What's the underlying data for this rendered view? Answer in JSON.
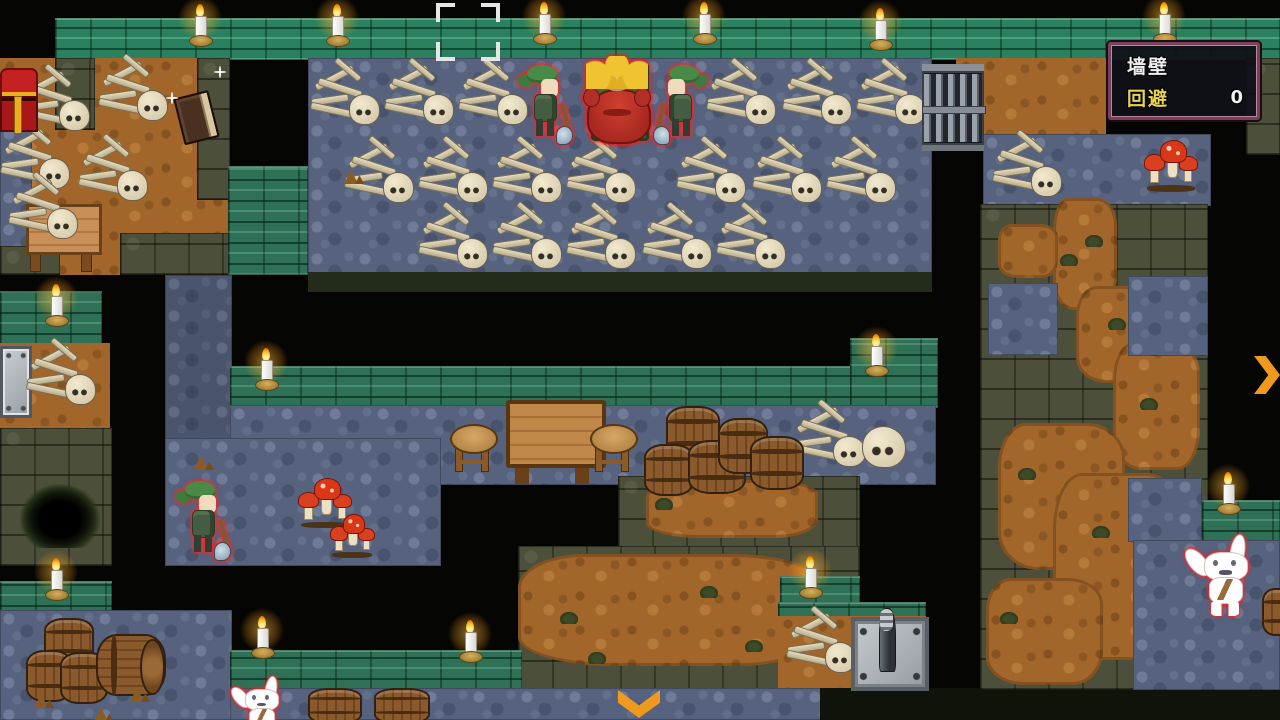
{
  "hud": {
    "wall_label": "墙壁",
    "evade_label": "回避",
    "evade_value": "0"
  },
  "palette": {
    "floor": "#56627e",
    "dirt": "#a2662a",
    "wall_green": "#2e7156",
    "stone": "#4c4f3a",
    "arrow": "#ef9a1c",
    "hud_border": "#7a3f5a",
    "hud_accent": "#e8d44f",
    "enemy_outline": "#ff2222"
  },
  "scene": {
    "terrain": [
      {
        "t": "wallTop",
        "x": 55,
        "y": 18,
        "w": 1225,
        "h": 42
      },
      {
        "t": "dirt",
        "x": 0,
        "y": 58,
        "w": 230,
        "h": 217
      },
      {
        "t": "stone",
        "x": 55,
        "y": 58,
        "w": 40,
        "h": 72
      },
      {
        "t": "stone",
        "x": 197,
        "y": 58,
        "w": 33,
        "h": 142
      },
      {
        "t": "floor",
        "x": 0,
        "y": 125,
        "w": 32,
        "h": 150
      },
      {
        "t": "stone",
        "x": 120,
        "y": 233,
        "w": 110,
        "h": 42
      },
      {
        "t": "stone",
        "x": 0,
        "y": 246,
        "w": 60,
        "h": 29
      },
      {
        "t": "floor",
        "x": 308,
        "y": 58,
        "w": 624,
        "h": 217
      },
      {
        "t": "wall",
        "x": 228,
        "y": 166,
        "w": 80,
        "h": 109
      },
      {
        "t": "dirt",
        "x": 956,
        "y": 58,
        "w": 50,
        "h": 80
      },
      {
        "t": "stoneDark",
        "x": 308,
        "y": 272,
        "w": 624,
        "h": 20
      },
      {
        "t": "floorDim",
        "x": 165,
        "y": 275,
        "w": 67,
        "h": 172
      },
      {
        "t": "wall",
        "x": 0,
        "y": 291,
        "w": 102,
        "h": 54
      },
      {
        "t": "dirt",
        "x": 0,
        "y": 343,
        "w": 110,
        "h": 92
      },
      {
        "t": "stone",
        "x": 0,
        "y": 428,
        "w": 112,
        "h": 138
      },
      {
        "t": "wall",
        "x": 230,
        "y": 366,
        "w": 708,
        "h": 42
      },
      {
        "t": "wall",
        "x": 850,
        "y": 338,
        "w": 88,
        "h": 70
      },
      {
        "t": "floor",
        "x": 230,
        "y": 405,
        "w": 706,
        "h": 80
      },
      {
        "t": "floor",
        "x": 165,
        "y": 438,
        "w": 276,
        "h": 128
      },
      {
        "t": "stone",
        "x": 618,
        "y": 476,
        "w": 242,
        "h": 74
      },
      {
        "t": "stone",
        "x": 518,
        "y": 546,
        "w": 342,
        "h": 146
      },
      {
        "t": "dirtBlob",
        "x": 646,
        "y": 480,
        "w": 172,
        "h": 58
      },
      {
        "t": "dirtBlob",
        "x": 518,
        "y": 554,
        "w": 302,
        "h": 112
      },
      {
        "t": "wall",
        "x": 780,
        "y": 576,
        "w": 80,
        "h": 40
      },
      {
        "t": "wall",
        "x": 778,
        "y": 602,
        "w": 148,
        "h": 16
      },
      {
        "t": "dirt",
        "x": 778,
        "y": 616,
        "w": 148,
        "h": 74
      },
      {
        "t": "wall",
        "x": 0,
        "y": 581,
        "w": 112,
        "h": 57
      },
      {
        "t": "floor",
        "x": 0,
        "y": 610,
        "w": 232,
        "h": 110
      },
      {
        "t": "wall",
        "x": 230,
        "y": 650,
        "w": 292,
        "h": 40
      },
      {
        "t": "floor",
        "x": 230,
        "y": 688,
        "w": 592,
        "h": 32
      },
      {
        "t": "stoneDark2",
        "x": 820,
        "y": 688,
        "w": 460,
        "h": 32
      },
      {
        "t": "dirt",
        "x": 980,
        "y": 58,
        "w": 126,
        "h": 80
      },
      {
        "t": "stone",
        "x": 1246,
        "y": 58,
        "w": 34,
        "h": 97
      },
      {
        "t": "floor",
        "x": 983,
        "y": 134,
        "w": 228,
        "h": 72
      },
      {
        "t": "stone",
        "x": 980,
        "y": 204,
        "w": 228,
        "h": 486
      },
      {
        "t": "dirtBlob",
        "x": 1053,
        "y": 198,
        "w": 64,
        "h": 112
      },
      {
        "t": "dirtBlob",
        "x": 998,
        "y": 224,
        "w": 60,
        "h": 54
      },
      {
        "t": "dirtBlob",
        "x": 1076,
        "y": 286,
        "w": 97,
        "h": 97
      },
      {
        "t": "dirtBlob",
        "x": 1113,
        "y": 343,
        "w": 87,
        "h": 127
      },
      {
        "t": "dirtBlob",
        "x": 998,
        "y": 423,
        "w": 127,
        "h": 147
      },
      {
        "t": "dirtBlob",
        "x": 1053,
        "y": 473,
        "w": 132,
        "h": 187
      },
      {
        "t": "dirtBlob",
        "x": 986,
        "y": 578,
        "w": 117,
        "h": 107
      },
      {
        "t": "floor",
        "x": 988,
        "y": 283,
        "w": 70,
        "h": 72
      },
      {
        "t": "floor",
        "x": 1128,
        "y": 276,
        "w": 80,
        "h": 80
      },
      {
        "t": "floor",
        "x": 1128,
        "y": 478,
        "w": 74,
        "h": 64
      },
      {
        "t": "wall",
        "x": 1202,
        "y": 500,
        "w": 78,
        "h": 42
      },
      {
        "t": "floor",
        "x": 1133,
        "y": 540,
        "w": 147,
        "h": 150
      }
    ],
    "sprites": [
      {
        "t": "pit",
        "x": 20,
        "y": 484
      },
      {
        "t": "plate",
        "x": 0,
        "y": 346
      },
      {
        "t": "tableFront",
        "x": 26,
        "y": 204
      },
      {
        "t": "skeleton",
        "x": 20,
        "y": 70
      },
      {
        "t": "skeleton",
        "x": 98,
        "y": 60
      },
      {
        "t": "skeleton",
        "x": 0,
        "y": 128
      },
      {
        "t": "skeleton",
        "x": 78,
        "y": 140
      },
      {
        "t": "skeleton",
        "x": 8,
        "y": 178
      },
      {
        "t": "skeleton",
        "x": 26,
        "y": 344
      },
      {
        "t": "skeleton",
        "x": 310,
        "y": 64
      },
      {
        "t": "skeleton",
        "x": 384,
        "y": 64
      },
      {
        "t": "skeleton",
        "x": 458,
        "y": 64
      },
      {
        "t": "skeleton",
        "x": 706,
        "y": 64
      },
      {
        "t": "skeleton",
        "x": 782,
        "y": 64
      },
      {
        "t": "skeleton",
        "x": 856,
        "y": 64
      },
      {
        "t": "skeleton",
        "x": 344,
        "y": 142
      },
      {
        "t": "skeleton",
        "x": 418,
        "y": 142
      },
      {
        "t": "skeleton",
        "x": 492,
        "y": 142
      },
      {
        "t": "skeleton",
        "x": 566,
        "y": 142
      },
      {
        "t": "skeleton",
        "x": 676,
        "y": 142
      },
      {
        "t": "skeleton",
        "x": 752,
        "y": 142
      },
      {
        "t": "skeleton",
        "x": 826,
        "y": 142
      },
      {
        "t": "skeleton",
        "x": 418,
        "y": 208
      },
      {
        "t": "skeleton",
        "x": 492,
        "y": 208
      },
      {
        "t": "skeleton",
        "x": 566,
        "y": 208
      },
      {
        "t": "skeleton",
        "x": 642,
        "y": 208
      },
      {
        "t": "skeleton",
        "x": 716,
        "y": 208
      },
      {
        "t": "skeleton",
        "x": 792,
        "y": 406,
        "w": 78,
        "h": 62
      },
      {
        "t": "skull",
        "x": 862,
        "y": 426
      },
      {
        "t": "skeleton",
        "x": 992,
        "y": 136
      },
      {
        "t": "skeleton",
        "x": 786,
        "y": 612
      },
      {
        "t": "chest",
        "x": 0,
        "y": 68
      },
      {
        "t": "book",
        "x": 170,
        "y": 94
      },
      {
        "t": "sparkle",
        "x": 214,
        "y": 66
      },
      {
        "t": "sparkle",
        "x": 166,
        "y": 92
      },
      {
        "t": "gate",
        "x": 922,
        "y": 64
      },
      {
        "t": "stool",
        "x": 450,
        "y": 422
      },
      {
        "t": "tableMid",
        "x": 506,
        "y": 400
      },
      {
        "t": "stool",
        "x": 590,
        "y": 422
      },
      {
        "t": "barrel",
        "x": 666,
        "y": 406,
        "w": 50,
        "h": 50
      },
      {
        "t": "barrel",
        "x": 644,
        "y": 444,
        "w": 46,
        "h": 48
      },
      {
        "t": "barrel",
        "x": 688,
        "y": 440,
        "w": 54,
        "h": 50
      },
      {
        "t": "barrel",
        "x": 718,
        "y": 418,
        "w": 46,
        "h": 52
      },
      {
        "t": "barrel",
        "x": 750,
        "y": 436,
        "w": 50,
        "h": 50
      },
      {
        "t": "barrel",
        "x": 44,
        "y": 618,
        "w": 46,
        "h": 44
      },
      {
        "t": "barrel",
        "x": 26,
        "y": 650,
        "w": 42,
        "h": 48
      },
      {
        "t": "barrel",
        "x": 60,
        "y": 652,
        "w": 44,
        "h": 48
      },
      {
        "t": "barrelSide",
        "x": 96,
        "y": 634
      },
      {
        "t": "barrel",
        "x": 308,
        "y": 688,
        "w": 50,
        "h": 32
      },
      {
        "t": "barrel",
        "x": 374,
        "y": 688,
        "w": 52,
        "h": 32
      },
      {
        "t": "barrel",
        "x": 1262,
        "y": 588,
        "w": 30,
        "h": 44
      },
      {
        "t": "mushroom",
        "x": 298,
        "y": 478
      },
      {
        "t": "mushroom",
        "x": 330,
        "y": 514,
        "w": 44,
        "h": 44
      },
      {
        "t": "mushroom",
        "x": 1144,
        "y": 140,
        "w": 54,
        "h": 52
      },
      {
        "t": "device",
        "x": 851,
        "y": 608
      },
      {
        "t": "arrowDown",
        "x": 618,
        "y": 690
      },
      {
        "t": "arrowRight",
        "x": 1254,
        "y": 356
      },
      {
        "t": "debris",
        "x": 344,
        "y": 168
      },
      {
        "t": "debris",
        "x": 194,
        "y": 454
      },
      {
        "t": "debris",
        "x": 34,
        "y": 692
      },
      {
        "t": "debris",
        "x": 94,
        "y": 706
      },
      {
        "t": "debris",
        "x": 130,
        "y": 686
      },
      {
        "t": "tuft",
        "x": 1085,
        "y": 235
      },
      {
        "t": "tuft",
        "x": 1108,
        "y": 318
      },
      {
        "t": "tuft",
        "x": 1140,
        "y": 398
      },
      {
        "t": "tuft",
        "x": 1018,
        "y": 468
      },
      {
        "t": "tuft",
        "x": 1092,
        "y": 526
      },
      {
        "t": "tuft",
        "x": 1000,
        "y": 612
      },
      {
        "t": "tuft",
        "x": 655,
        "y": 498
      },
      {
        "t": "tuft",
        "x": 700,
        "y": 586
      },
      {
        "t": "tuft",
        "x": 560,
        "y": 612
      },
      {
        "t": "tuft",
        "x": 745,
        "y": 640
      },
      {
        "t": "tuft",
        "x": 588,
        "y": 652
      },
      {
        "t": "tuft",
        "x": 1060,
        "y": 254
      },
      {
        "t": "soldier",
        "x": 522,
        "y": 64
      },
      {
        "t": "boss",
        "x": 582,
        "y": 56
      },
      {
        "t": "soldier",
        "x": 656,
        "y": 64,
        "f": 1
      },
      {
        "t": "soldier",
        "x": 180,
        "y": 480
      },
      {
        "t": "rabbit",
        "x": 1188,
        "y": 536
      },
      {
        "t": "rabbit",
        "x": 233,
        "y": 678,
        "w": 56,
        "h": 60
      },
      {
        "t": "candle",
        "x": 188,
        "y": 4
      },
      {
        "t": "candle",
        "x": 325,
        "y": 4
      },
      {
        "t": "candle",
        "x": 532,
        "y": 2
      },
      {
        "t": "candle",
        "x": 692,
        "y": 2
      },
      {
        "t": "candle",
        "x": 868,
        "y": 8
      },
      {
        "t": "candle",
        "x": 1152,
        "y": 2
      },
      {
        "t": "candle",
        "x": 44,
        "y": 284
      },
      {
        "t": "candle",
        "x": 254,
        "y": 348
      },
      {
        "t": "candle",
        "x": 864,
        "y": 334
      },
      {
        "t": "candle",
        "x": 44,
        "y": 558
      },
      {
        "t": "candle",
        "x": 250,
        "y": 616
      },
      {
        "t": "candle",
        "x": 458,
        "y": 620
      },
      {
        "t": "candle",
        "x": 798,
        "y": 556
      },
      {
        "t": "candle",
        "x": 1216,
        "y": 472
      },
      {
        "t": "bracket",
        "x": 436,
        "y": 3
      }
    ]
  }
}
